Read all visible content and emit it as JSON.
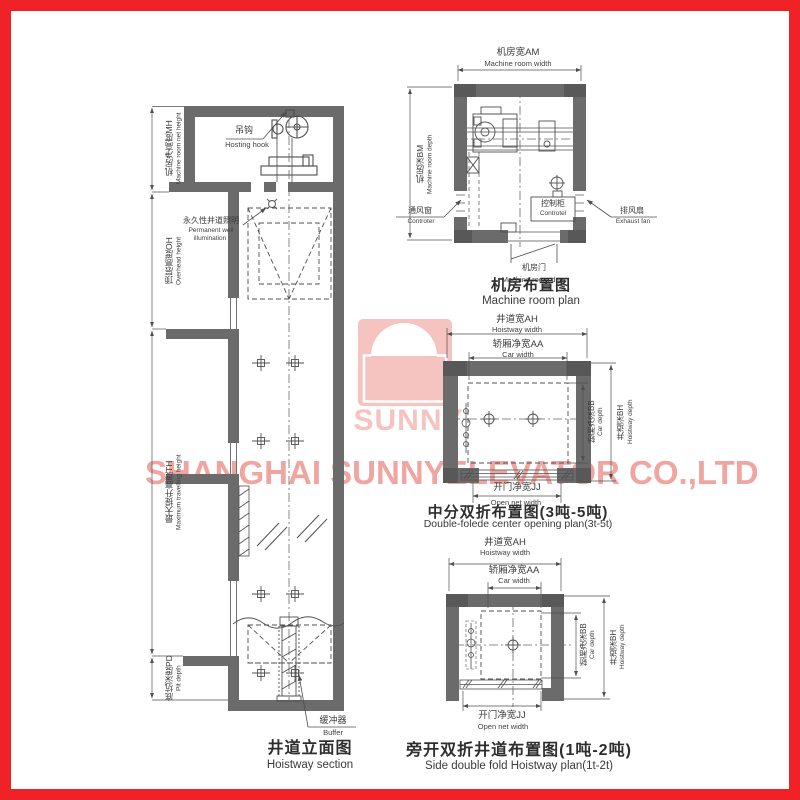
{
  "watermark": {
    "brand": "SUNNY",
    "company": "SHANGHAI SUNNYELEVATOR CO.,LTD"
  },
  "hoistway_section": {
    "title_cn": "井道立面图",
    "title_en": "Hoistway section",
    "dims": {
      "mh_cn": "机房净高度MH",
      "mh_en": "Machine room net height",
      "oh_cn": "顶层高度OH",
      "oh_en": "Overhead height",
      "th_cn": "最大提升高度TH",
      "th_en": "Maximum travelling height",
      "pd_cn": "底坑深度PD",
      "pd_en": "Pit depth"
    },
    "callouts": {
      "hook_cn": "吊钩",
      "hook_en": "Hosting hook",
      "light_cn": "永久性井道照明",
      "light_en1": "Permanent well",
      "light_en2": "illumination",
      "buffer_cn": "缓冲器",
      "buffer_en": "Buffer"
    }
  },
  "machine_room_plan": {
    "title_cn": "机房布置图",
    "title_en": "Machine room plan",
    "dims": {
      "am_cn": "机房宽AM",
      "am_en": "Machine room width",
      "bm_cn": "机房深BM",
      "bm_en": "Machine room depth"
    },
    "callouts": {
      "vent_cn": "通风窗",
      "vent_en": "Controter",
      "cabinet_cn": "控制柜",
      "cabinet_en": "Controtel",
      "fan_cn": "排风扇",
      "fan_en": "Exhaust fan",
      "door_cn": "机房门",
      "door_en": "Machine room door"
    }
  },
  "center_plan": {
    "title_cn": "中分双折布置图(3吨-5吨)",
    "title_en": "Double-folede center opening plan(3t-5t)",
    "dims": {
      "ah_cn": "井道宽AH",
      "ah_en": "Hoistway width",
      "aa_cn": "轿厢净宽AA",
      "aa_en": "Car width",
      "bb_cn": "轿厢净深BB",
      "bb_en": "Car depth",
      "bh_cn": "井道深BH",
      "bh_en": "Hoistway depth",
      "jj_cn": "开门净宽JJ",
      "jj_en": "Open net width"
    }
  },
  "side_plan": {
    "title_cn": "旁开双折井道布置图(1吨-2吨)",
    "title_en": "Side double fold Hoistway plan(1t-2t)",
    "dims": {
      "ah_cn": "井道宽AH",
      "ah_en": "Hoistway width",
      "aa_cn": "轿厢净宽AA",
      "aa_en": "Car width",
      "bb_cn": "轿厢净深BB",
      "bb_en": "Car depth",
      "bh_cn": "井道深BH",
      "bh_en": "Hoistway depth",
      "jj_cn": "开门净宽JJ",
      "jj_en": "Open net width"
    }
  },
  "colors": {
    "frame_red": "#ee2227",
    "wall_gray": "#6b6b6b",
    "line_gray": "#4f4f4f",
    "watermark_pink": "#f5c3c0",
    "watermark_pink_strong": "#f0a5a1"
  }
}
